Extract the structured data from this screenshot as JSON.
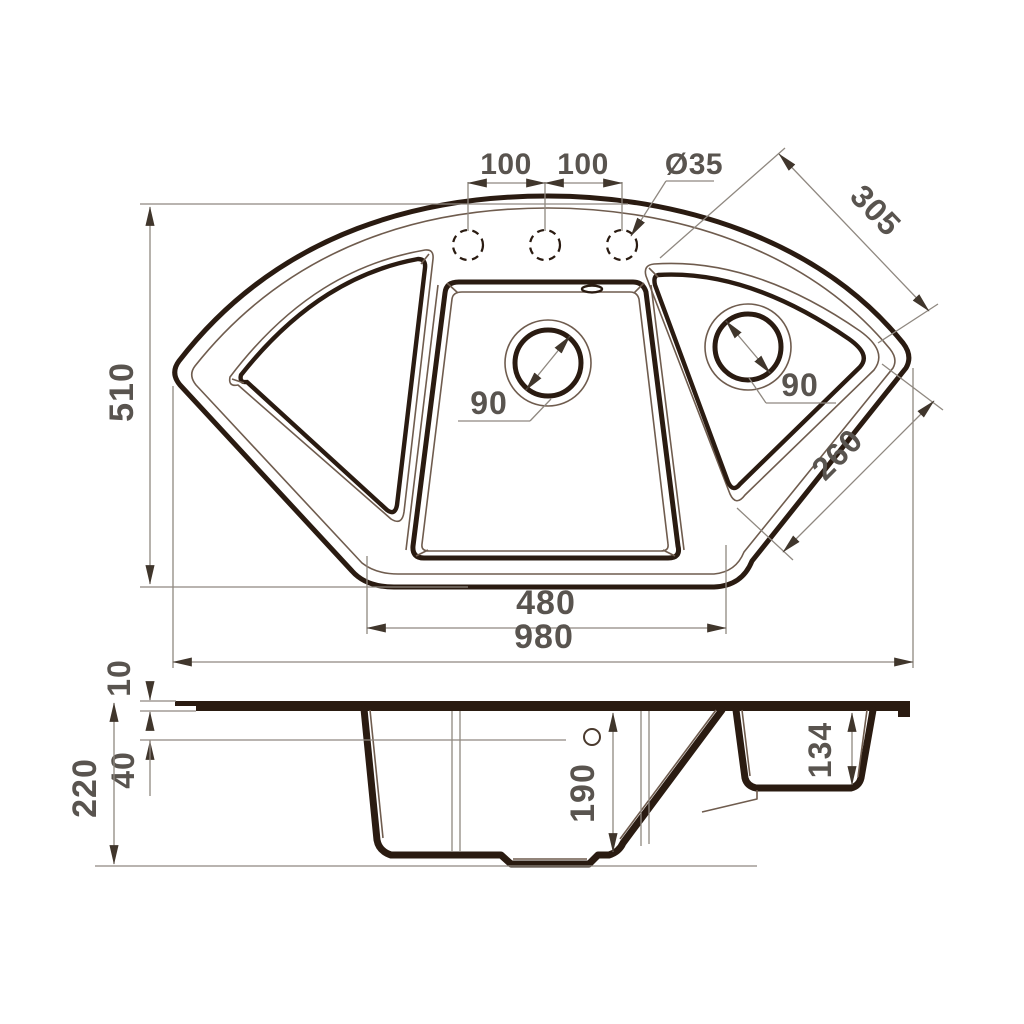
{
  "drawing": {
    "type": "sink-technical-drawing",
    "colors": {
      "background": "#ffffff",
      "outline": "#2a1b11",
      "thin_line": "#6f5c4e",
      "dimension_line": "#8f8880",
      "arrow": "#40362c",
      "label_text": "#59544f"
    },
    "top_view": {
      "faucet_pitch_left": "100",
      "faucet_pitch_right": "100",
      "faucet_hole_diameter": "Ø35",
      "overall_depth": "510",
      "right_top_edge": "305",
      "main_bowl_drain": "90",
      "second_bowl_drain": "90",
      "right_lower_edge": "260",
      "bottom_edge": "480",
      "overall_width": "980"
    },
    "section_view": {
      "rim_thickness": "10",
      "deck_drop": "40",
      "overall_height": "220",
      "main_bowl_depth": "190",
      "second_bowl_depth": "134"
    }
  }
}
